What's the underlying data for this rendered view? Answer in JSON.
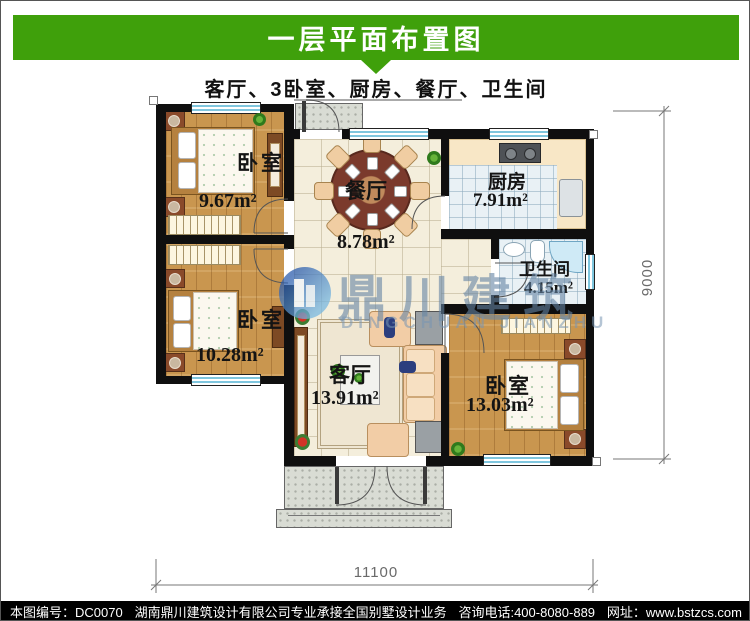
{
  "header": {
    "title": "一层平面布置图",
    "subtitle": "客厅、3卧室、厨房、餐厅、卫生间",
    "bar_color": "#3fa00b"
  },
  "plan": {
    "rooms": [
      {
        "key": "bedroom_top_left",
        "label": "卧室",
        "area": "9.67m²"
      },
      {
        "key": "bedroom_mid_left",
        "label": "卧室",
        "area": "10.28m²"
      },
      {
        "key": "dining",
        "label": "餐厅",
        "area": "8.78m²"
      },
      {
        "key": "kitchen",
        "label": "厨房",
        "area": "7.91m²"
      },
      {
        "key": "bathroom",
        "label": "卫生间",
        "area": "4.15m²"
      },
      {
        "key": "living",
        "label": "客厅",
        "area": "13.91m²"
      },
      {
        "key": "bedroom_bot_right",
        "label": "卧室",
        "area": "13.03m²"
      }
    ],
    "dimensions": {
      "width": "11100",
      "height": "9000"
    }
  },
  "watermark": {
    "cn": "鼎川建筑",
    "en": "DINGCHUAN JIANZHU"
  },
  "footer": {
    "drawing_no": "本图编号：DC0070",
    "company": "湖南鼎川建筑设计有限公司专业承接全国别墅设计业务",
    "phone": "咨询电话:400-8080-889",
    "website": "网址：www.bstzcs.com"
  }
}
